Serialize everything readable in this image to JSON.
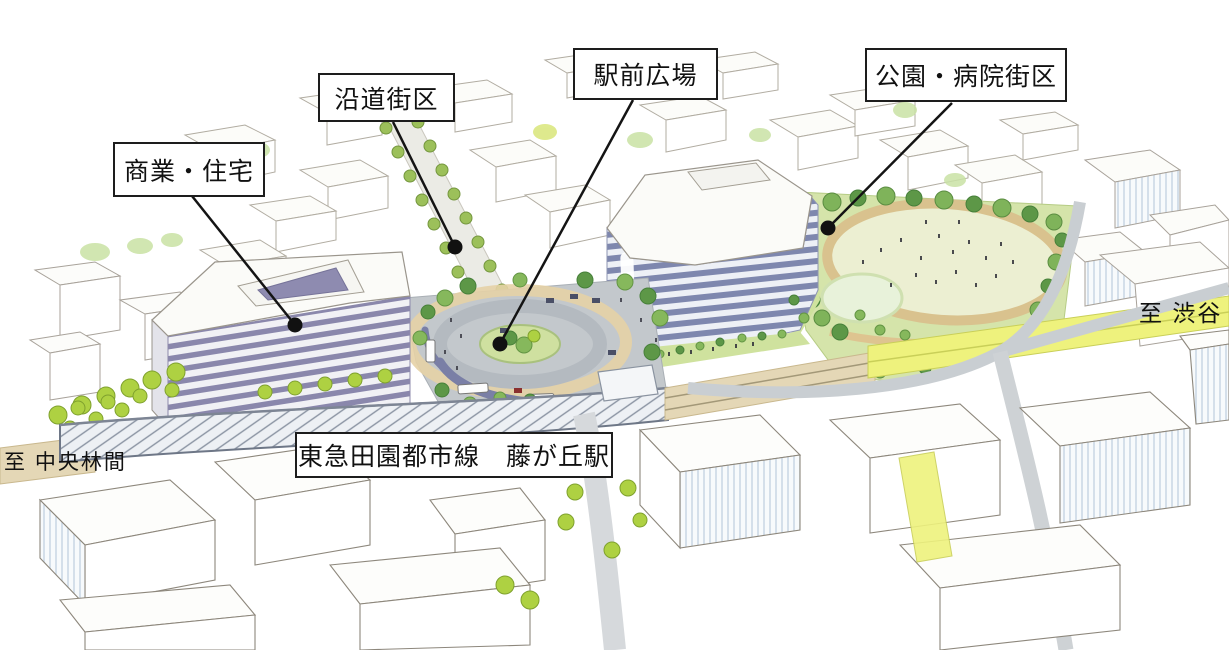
{
  "labels": {
    "commercial_residential": "商業・住宅",
    "roadside_block": "沿道街区",
    "station_plaza": "駅前広場",
    "park_hospital_block": "公園・病院街区",
    "railway_station": "東急田園都市線　藤が丘駅",
    "to_shibuya": "至 渋谷",
    "to_chuo_rinkan": "至 中央林間"
  },
  "colors": {
    "ink": "#141414",
    "box_border": "#1d1d1d",
    "building_stripe": "#7e87ae",
    "building_stripe_light": "#edf0f6",
    "left_building_stripe": "#8a87ac",
    "left_building_stripe_light": "#f1f1f5",
    "roof_white": "#fbfbf8",
    "tree_bright": "#aed142",
    "tree_dark": "#5d9747",
    "tree_medium": "#86b85c",
    "tree_soft": "#c9e2a4",
    "lawn": "#ecefd2",
    "park_green": "#d5e4aa",
    "path_tan": "#dfc08d",
    "plaza_gray": "#c3c8cc",
    "apron_tan": "#e6d2a6",
    "road_gray": "#c9ced2",
    "rail_yellow": "#eef27d",
    "ballast_tan": "#e4d7b6",
    "canopy_line": "#77808f",
    "sketch_line": "#a8a29a",
    "shade_blue": "#d9e3ed",
    "canopy_purple": "#7a7fa6"
  }
}
